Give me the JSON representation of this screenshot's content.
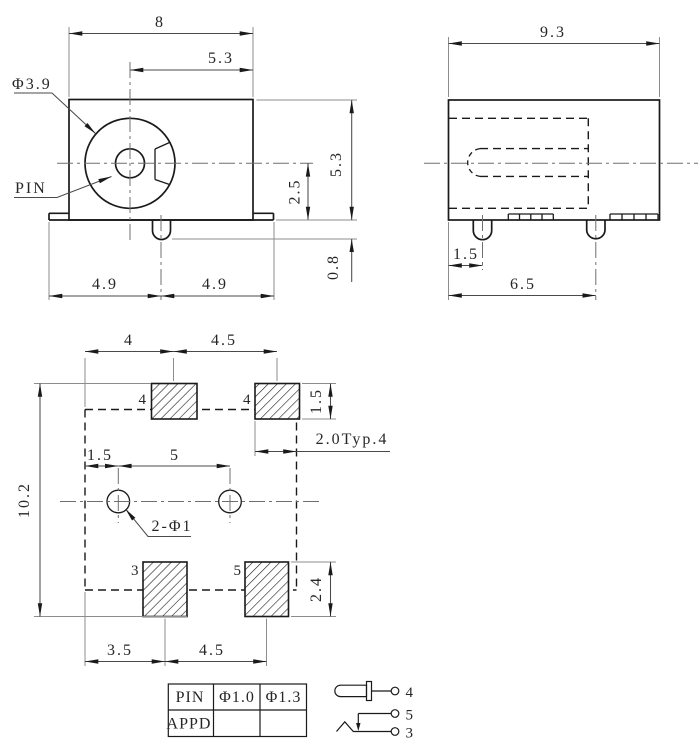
{
  "front_view": {
    "dim_overall_width": "8",
    "dim_center_to_right": "5.3",
    "barrel_diameter_callout": "Φ3.9",
    "pin_callout": "PIN",
    "dim_center_to_bottom": "2.5",
    "dim_overall_height": "5.3",
    "dim_leg_protrusion": "0.8",
    "dim_left_half": "4.9",
    "dim_right_half": "4.9"
  },
  "side_view": {
    "dim_overall_depth": "9.3",
    "dim_leg_offset": "1.5",
    "dim_leg_span": "6.5"
  },
  "bottom_view": {
    "dim_pad_top_offset": "4",
    "dim_pad_top_pitch": "4.5",
    "dim_pad_top_height": "1.5",
    "dim_pad_width_typ": "2.0Typ.4",
    "dim_hole_offset": "1.5",
    "dim_hole_pitch": "5",
    "dim_overall_depth": "10.2",
    "hole_callout": "2-Φ1",
    "dim_pad_bottom_height": "2.4",
    "dim_pad_bottom_offset": "3.5",
    "dim_pad_bottom_pitch": "4.5",
    "pad_labels": {
      "top_left": "4",
      "top_right": "4",
      "bottom_left": "3",
      "bottom_right": "5"
    }
  },
  "table": {
    "rows": [
      [
        "PIN",
        "Φ1.0",
        "Φ1.3"
      ],
      [
        "APPD",
        "",
        ""
      ]
    ]
  },
  "schematic": {
    "terminal_tip": "4",
    "terminal_contact": "5",
    "terminal_sleeve": "3"
  },
  "colors": {
    "ink": "#1a1a1a",
    "background": "#ffffff"
  }
}
